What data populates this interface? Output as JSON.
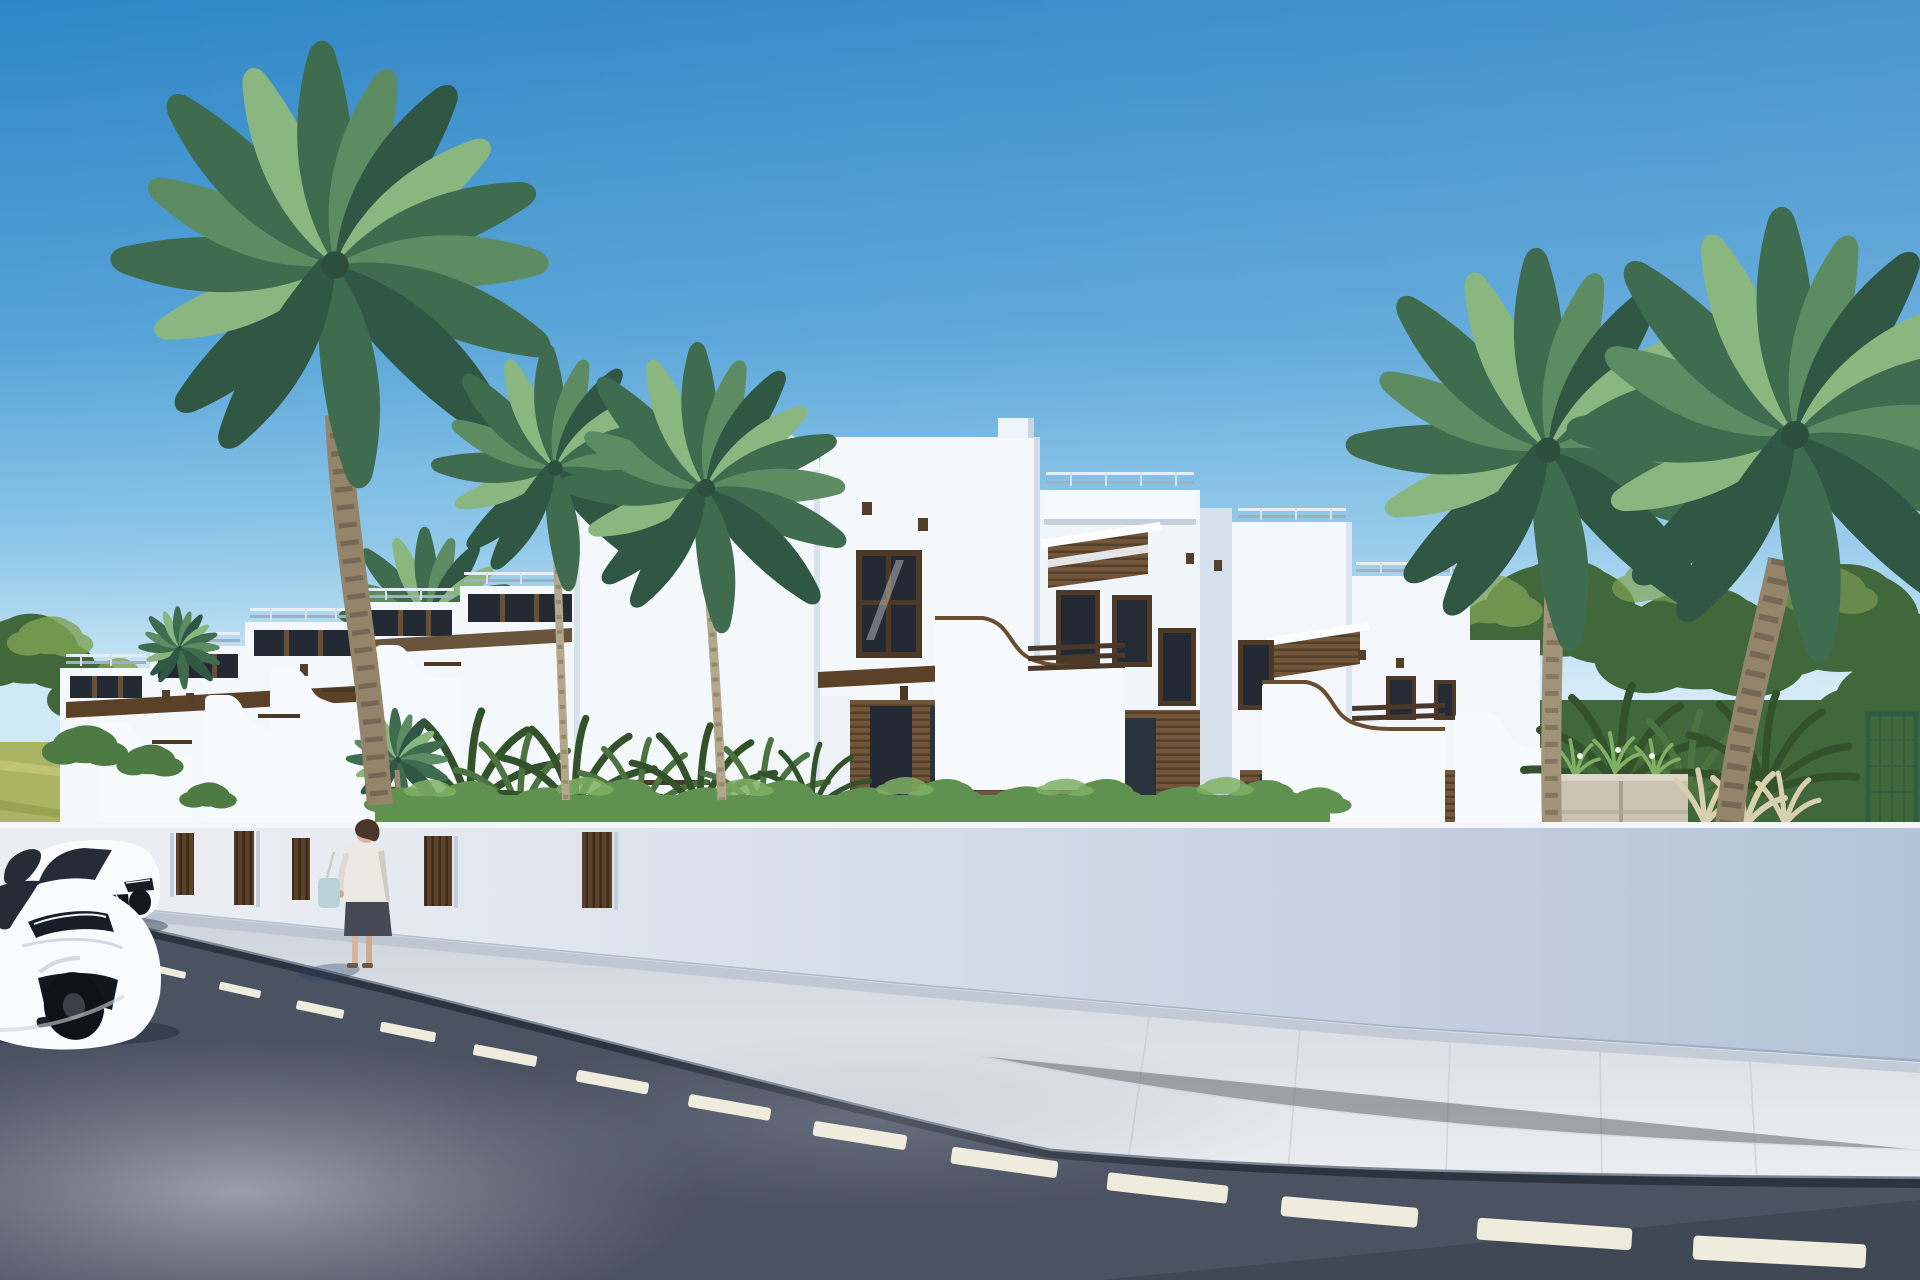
{
  "meta": {
    "alt": "Sunny 3D architectural render of a row of white two-storey Mediterranean townhouses with wood-slat accents, curved balcony parapets and roof pergolas, behind a white street wall with wooden gates; palm trees, hedges and background trees; a woman with a shoulder bag stands on the sidewalk near two parked white cars; an asphalt road with a dashed center line crosses the foreground"
  },
  "counts": {
    "palm_trees": 7,
    "cars": 2,
    "pedestrians": 1,
    "wall_gates": 5,
    "lane_dashes": 14
  },
  "colors": {
    "sky_top": "#2f86c6",
    "sky_mid": "#55a3d8",
    "sky_low": "#8ec7e9",
    "sky_horizon": "#cfe9f6",
    "building_lit": "#f4f8fb",
    "building_shade": "#dde7f1",
    "building_side": "#c9d7e5",
    "wood": "#73563a",
    "wood_dark": "#54402a",
    "glass": "#232a33",
    "wall_lit": "#eaeef3",
    "wall_shade": "#b4c3d8",
    "gate_wood": "#5a4128",
    "gate_wood_dark": "#3a2b1b",
    "sidewalk": "#dfe3e8",
    "curb": "#2c3440",
    "curb_top": "#7b8694",
    "road": "#4b5262",
    "road_reflection": "#a7adb8",
    "lane_dash": "#efecdd",
    "car_body": "#fafbfd",
    "car_glass": "#252c35",
    "palm_dark": "#3f6b4f",
    "palm_mid": "#5d8c63",
    "palm_light": "#8ab77f",
    "palm_deep": "#2f5743",
    "trunk": "#93846a",
    "trunk_slim": "#b3a78c",
    "trunk_ring": "#6e6250",
    "hedge": "#5f9150",
    "hedge_light": "#7fb063",
    "fern": "#4c7340",
    "fern_dark": "#33522c",
    "tree_light": "#7fa355",
    "tree_dark": "#41683a",
    "field": "#aab463",
    "stone": "#cbc3b4",
    "stone_light": "#ddd6c8",
    "grass_pale": "#d8cfae",
    "mesh_green": "#2e5b43",
    "skin": "#d8b49c",
    "hair": "#4a372a",
    "jacket": "#ece9e3",
    "skirt": "#454a56",
    "bag": "#b9d2da"
  }
}
